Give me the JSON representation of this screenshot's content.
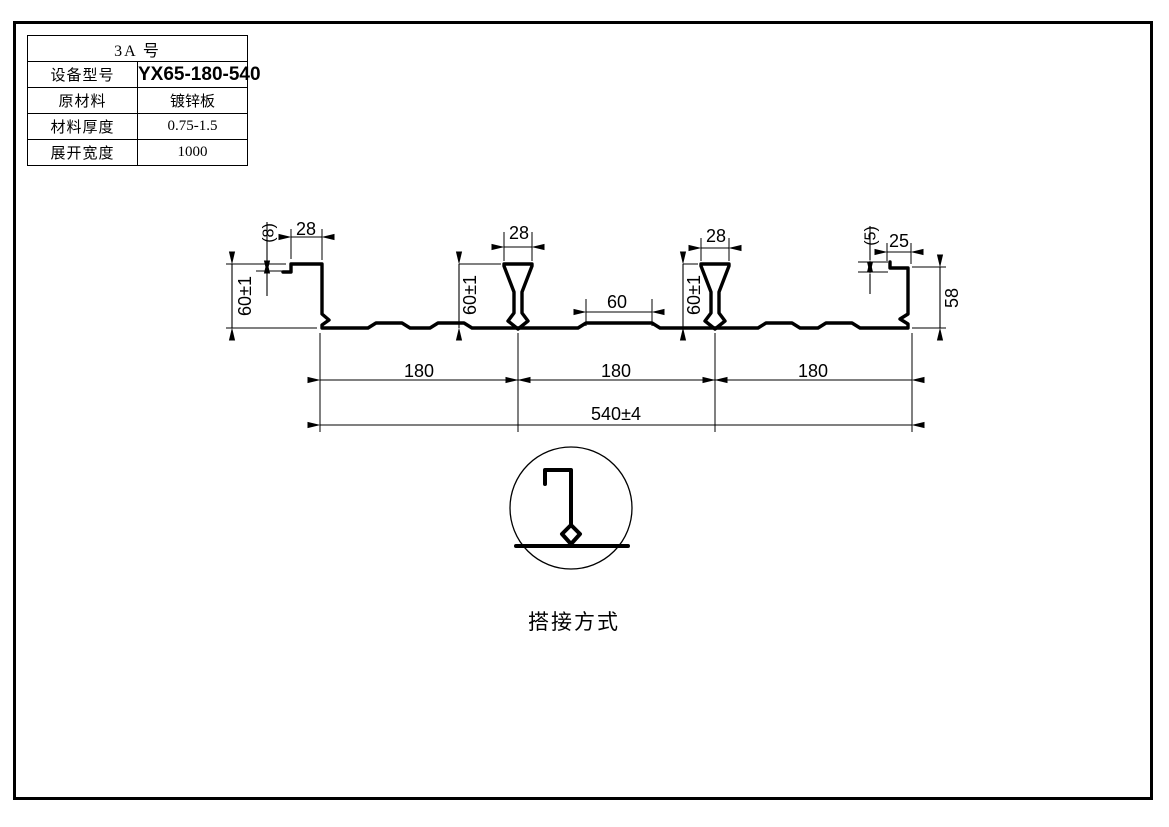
{
  "colors": {
    "line": "#000000",
    "bg": "#ffffff"
  },
  "title_block": {
    "header": "3A  号",
    "rows": [
      {
        "label": "设备型号",
        "value": "YX65-180-540"
      },
      {
        "label": "原材料",
        "value": "镀锌板"
      },
      {
        "label": "材料厚度",
        "value": "0.75-1.5"
      },
      {
        "label": "展开宽度",
        "value": "1000"
      }
    ]
  },
  "dims": {
    "left_lip": "(8)",
    "left_flange": "28",
    "left_height": "60±1",
    "rib1_width": "28",
    "rib1_height": "60±1",
    "rib2_width": "28",
    "rib2_height": "60±1",
    "mid_emboss": "60",
    "right_lip": "(5)",
    "right_flange": "25",
    "right_height": "58",
    "seg1": "180",
    "seg2": "180",
    "seg3": "180",
    "overall": "540±4"
  },
  "detail": {
    "caption": "搭接方式"
  }
}
